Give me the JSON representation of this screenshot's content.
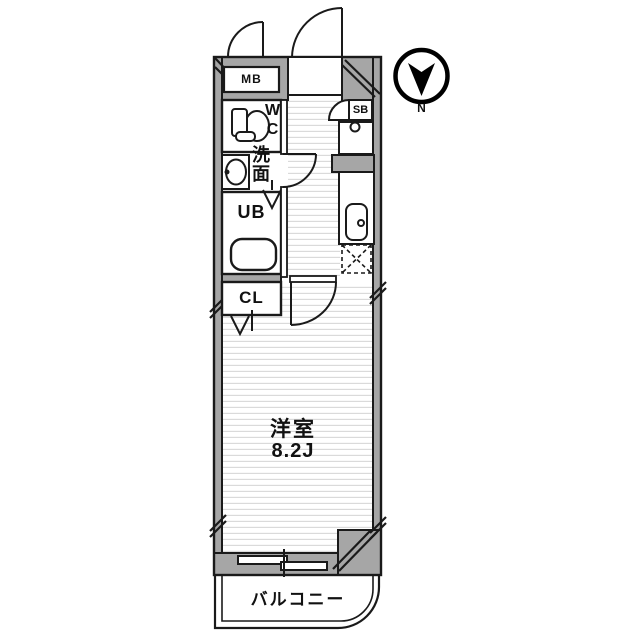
{
  "plan": {
    "type": "apartment-floor-plan",
    "rooms": {
      "meter_box": "MB",
      "shoe_box": "SB",
      "toilet": "WC",
      "washroom": "洗面",
      "unit_bath": "UB",
      "closet": "CL",
      "main_room_name": "洋室",
      "main_room_size": "8.2J",
      "balcony": "バルコニー"
    },
    "compass": {
      "label": "N"
    },
    "colors": {
      "wall_fill": "#a6a6a6",
      "outline": "#1a1a1a",
      "floor_stripe": "#dadada",
      "background": "#ffffff"
    },
    "icons": {
      "north_compass": "circle with black needle pointing down to N",
      "doors": "quarter-arc swing doors, V folding doors, sliding window",
      "fixtures": "toilet, washbasin, bathtub, kitchen sink, washing-machine space (dashed X)"
    }
  }
}
